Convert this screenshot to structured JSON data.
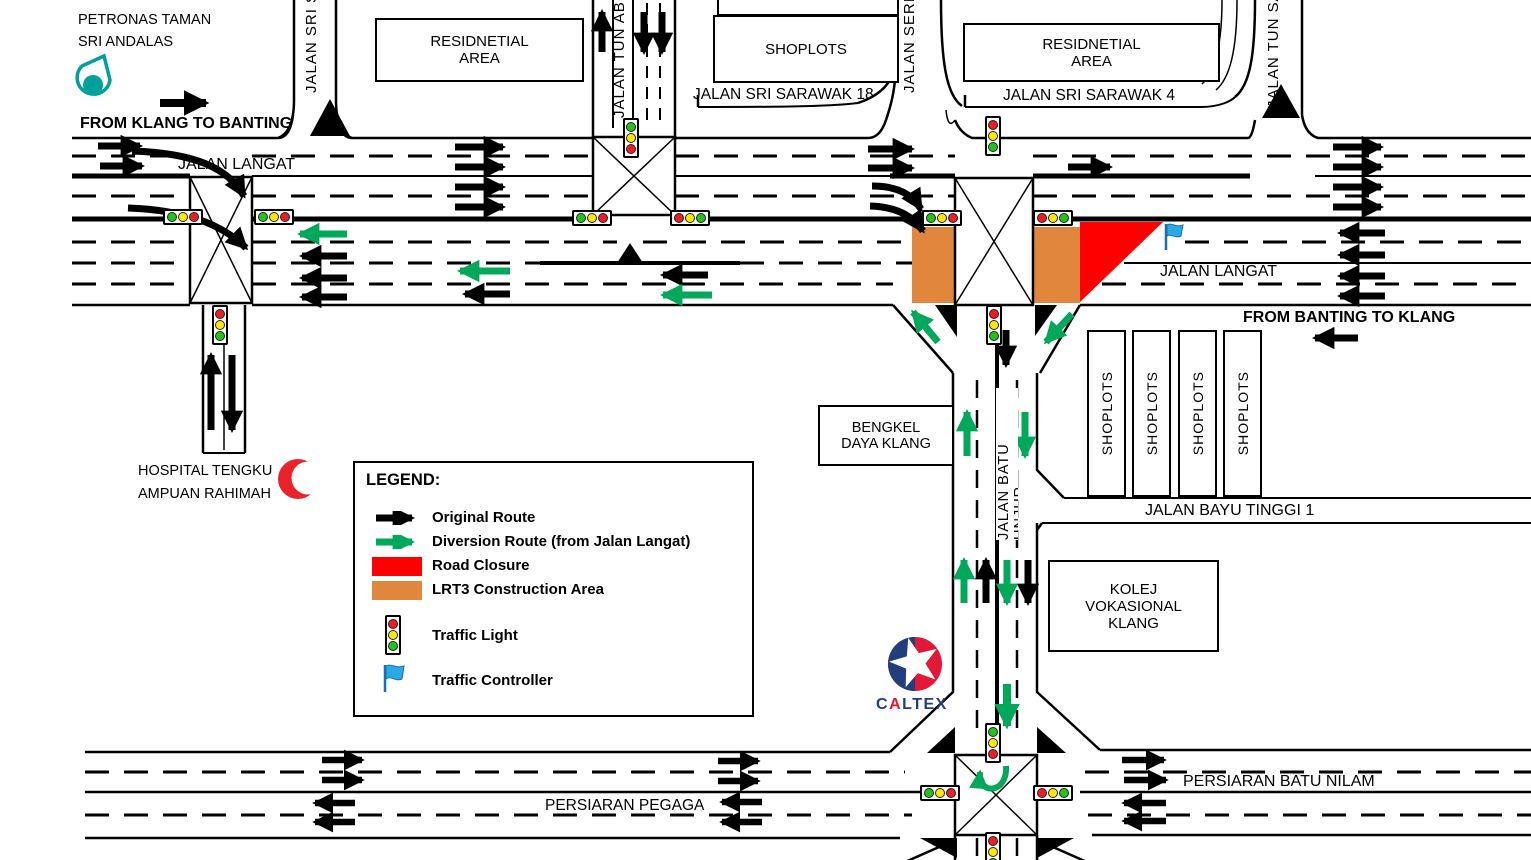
{
  "labels": {
    "petronas": "PETRONAS TAMAN\nSRI ANDALAS",
    "from_klang_to_banting": "FROM KLANG TO BANTING",
    "jalan_langat_west": "JALAN LANGAT",
    "jalan_langat_east": "JALAN LANGAT",
    "from_banting_to_klang": "FROM BANTING TO KLANG",
    "residential_area_west": "RESIDNETIAL\nAREA",
    "residential_area_east": "RESIDNETIAL\nAREA",
    "shoplots_north": "SHOPLOTS",
    "jalan_sri_sarawak_18": "JALAN SRI SARAWAK 18",
    "jalan_sri_sarawak_4": "JALAN SRI SARAWAK 4",
    "jalan_sri_se": "JALAN SRI SE",
    "jalan_tun_abd": "JALAN TUN ABD",
    "jalan_seri_s": "JALAN SERI S",
    "jalan_tun_sa": "JALAN TUN SA",
    "hospital": "HOSPITAL TENGKU\nAMPUAN RAHIMAH",
    "bengkel": "BENGKEL\nDAYA KLANG",
    "jalan_batu_unjur": "JALAN BATU UNJUR",
    "jalan_bayu_tinggi_1": "JALAN BAYU TINGGI 1",
    "kolej": "KOLEJ\nVOKASIONAL\nKLANG",
    "persiaran_pegaga": "PERSIARAN PEGAGA",
    "persiaran_batu_nilam": "PERSIARAN BATU NILAM"
  },
  "shoplots_vertical": [
    "SHOPLOTS",
    "SHOPLOTS",
    "SHOPLOTS",
    "SHOPLOTS"
  ],
  "caltex": {
    "c": "C",
    "a": "A",
    "rest": "LTEX"
  },
  "legend": {
    "title": "LEGEND:",
    "items": [
      {
        "icon": "black-arrow",
        "label": "Original Route"
      },
      {
        "icon": "green-arrow",
        "label": "Diversion Route (from Jalan Langat)"
      },
      {
        "icon": "red-rect",
        "label": "Road Closure"
      },
      {
        "icon": "orange-rect",
        "label": "LRT3 Construction Area"
      },
      {
        "icon": "traffic-light",
        "label": "Traffic Light"
      },
      {
        "icon": "blue-flag",
        "label": "Traffic Controller"
      }
    ]
  },
  "colors": {
    "original_route": "#000000",
    "diversion_route": "#00a859",
    "road_closure": "#fe0000",
    "lrt3_construction": "#e0873d",
    "traffic_light_red": "#ee1c25",
    "traffic_light_yellow": "#ffe900",
    "traffic_light_green": "#20c517",
    "traffic_controller_blue": "#29abe2",
    "petronas_teal": "#00a19c",
    "crescent_red": "#e8232a",
    "caltex_navy": "#233e7d",
    "caltex_red": "#e21836"
  }
}
